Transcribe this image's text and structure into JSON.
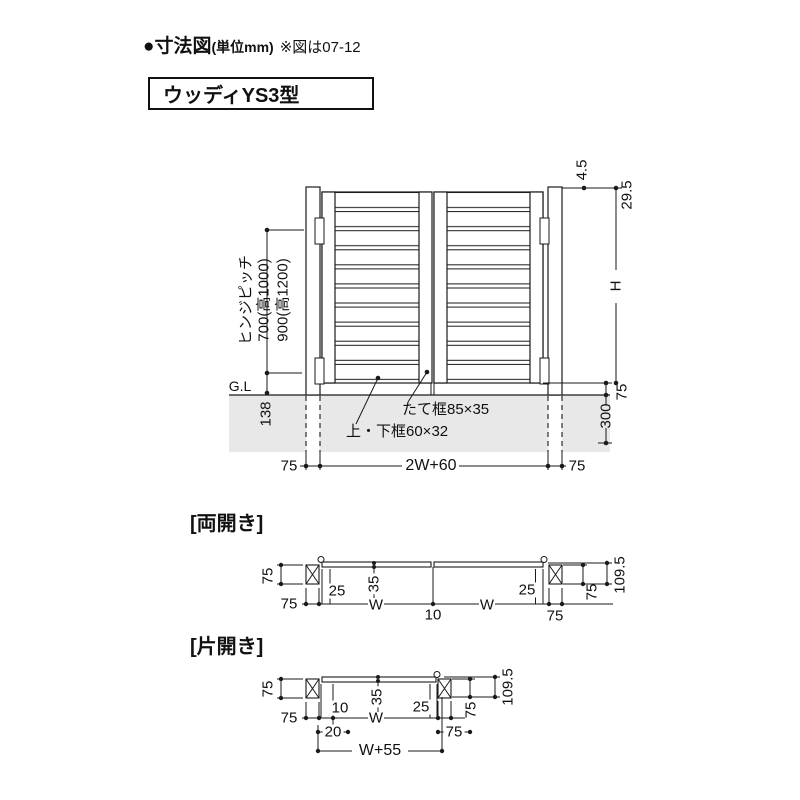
{
  "header": {
    "title_main": "●寸法図",
    "title_unit": "(単位mm)",
    "title_note": "※図は07-12",
    "product": "ウッディYS3型"
  },
  "elevation": {
    "gl": "G.L",
    "hinge_pitch_line1": "ヒンジピッチ",
    "hinge_pitch_line2": "700(高1000)",
    "hinge_pitch_line3": "900(高1200)",
    "dim_138": "138",
    "dim_4_5": "4.5",
    "dim_29_5": "29.5",
    "dim_h": "H",
    "dim_75_right": "75",
    "dim_300": "300",
    "label_stile": "たて框85×35",
    "label_rails": "上・下框60×32",
    "dim_75_bottom_left": "75",
    "dim_2w60": "2W+60",
    "dim_75_bottom_right": "75"
  },
  "ryobiraki": {
    "title": "[両開き]",
    "dim_75_left": "75",
    "dim_75_bottom_left": "75",
    "dim_25_left": "25",
    "dim_35": "35",
    "dim_w_left": "W",
    "dim_10": "10",
    "dim_w_right": "W",
    "dim_25_right": "25",
    "dim_75_bottom_right": "75",
    "dim_75_right": "75",
    "dim_109_5": "109.5"
  },
  "katabiraki": {
    "title": "[片開き]",
    "dim_75_left": "75",
    "dim_75_bottom_left": "75",
    "dim_10": "10",
    "dim_35": "35",
    "dim_w": "W",
    "dim_25": "25",
    "dim_20": "20",
    "dim_75_bottom_right": "75",
    "dim_75_right": "75",
    "dim_109_5": "109.5",
    "dim_w55": "W+55"
  }
}
